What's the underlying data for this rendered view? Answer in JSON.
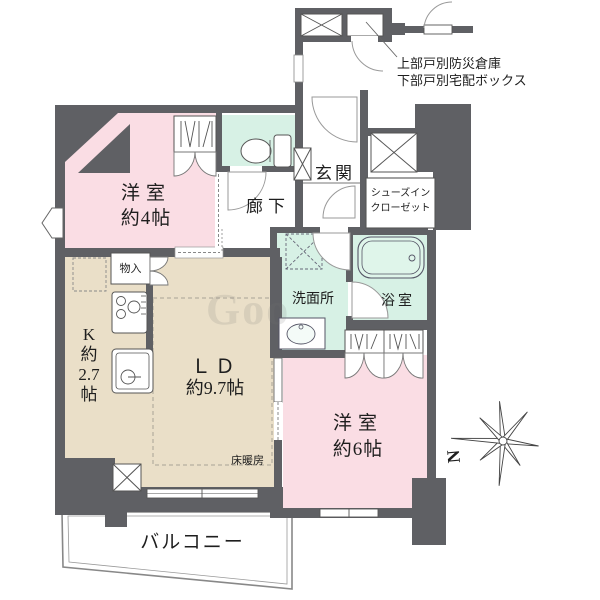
{
  "annotation": {
    "line1": "上部戸別防災倉庫",
    "line2": "下部戸別宅配ボックス"
  },
  "rooms": {
    "western4": {
      "name": "洋室",
      "size": "約4帖"
    },
    "hallway": {
      "name": "廊下"
    },
    "entrance": {
      "name": "玄関"
    },
    "shoes_closet": {
      "line1": "シューズイン",
      "line2": "クローゼット"
    },
    "washroom": {
      "name": "洗面所"
    },
    "bathroom": {
      "name": "浴室"
    },
    "kitchen": {
      "name": "K",
      "approx": "約",
      "size": "2.7",
      "unit": "帖"
    },
    "living_dining": {
      "name": "ＬＤ",
      "size": "約9.7帖"
    },
    "floor_heating": {
      "name": "床暖房"
    },
    "storage": {
      "name": "物入"
    },
    "western6": {
      "name": "洋室",
      "size": "約6帖"
    },
    "balcony": {
      "name": "バルコニー"
    }
  },
  "compass": {
    "north": "N"
  },
  "watermark": "Goo",
  "colors": {
    "wall": "#5f6064",
    "room_pink": "#fadde4",
    "room_beige": "#eadfc8",
    "room_mint": "#d7f1e5",
    "bathtub_mint": "#dff5ea",
    "line": "#555555"
  }
}
